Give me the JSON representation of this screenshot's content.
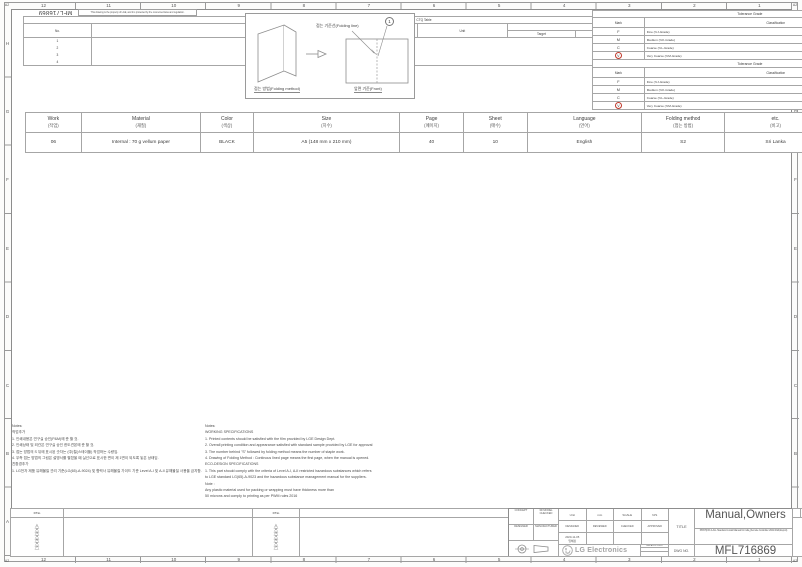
{
  "sheet": {
    "corner": "A2",
    "cols": [
      "12",
      "11",
      "10",
      "9",
      "8",
      "7",
      "6",
      "5",
      "4",
      "3",
      "2",
      "1"
    ],
    "rows": [
      "H",
      "G",
      "F",
      "E",
      "D",
      "C",
      "B",
      "A"
    ]
  },
  "header": {
    "doc_number_rotated": "MFL716869",
    "property_note": "This drawing is the property of LGE, and it is protected by the concerned laws and regulation."
  },
  "ctq": {
    "title": "CTQ Table",
    "no": "No.",
    "item": "CTQ Item",
    "unit": "Unit",
    "value_tolerance": "Value & Tolerance",
    "target": "Target",
    "lsl": "LSL",
    "usl": "USL",
    "z_value": "Z-Value",
    "zst": "Zst",
    "zlt": "Zlt",
    "row_numbers": [
      "1",
      "2",
      "3",
      "4"
    ]
  },
  "folding": {
    "line_label": "접는 기준선(Folding line)",
    "method_label": "접는 방법(Folding method)",
    "front_label": "앞면 기준(Front)",
    "callout": "1"
  },
  "tol_len": {
    "grade": "Tolerance Grade",
    "mark": "Mark",
    "classification": "Classification",
    "group": "Length(L:mm)",
    "cols": [
      "0.5~3",
      "3~6",
      "6~30",
      "30~ 120",
      "120~ 400",
      "400~ 1000",
      "1000~ 2000",
      "2000~ 4000"
    ],
    "rows": [
      {
        "mark": "F",
        "cls": "Fine (≒J-Grade)",
        "circled": false,
        "v": [
          "0.05",
          "0.05",
          "0.1",
          "0.15",
          "0.2",
          "0.3",
          "0.5",
          "-"
        ]
      },
      {
        "mark": "M",
        "cls": "Medium (≒K-Grade)",
        "circled": false,
        "v": [
          "0.1",
          "0.1",
          "0.2",
          "0.3",
          "0.5",
          "0.8",
          "1.2",
          "2.0"
        ]
      },
      {
        "mark": "C",
        "cls": "Coarse (≒L-Grade)",
        "circled": false,
        "v": [
          "0.2",
          "0.3",
          "0.5",
          "0.8",
          "1.2",
          "2.0",
          "3.0",
          "4.0"
        ]
      },
      {
        "mark": "V",
        "cls": "Very Coarse (≒M-Grade)",
        "circled": true,
        "v": [
          "-",
          "0.5",
          "1.0",
          "1.5",
          "2.5",
          "4.0",
          "6.0",
          "8.0"
        ]
      }
    ]
  },
  "tol_ra": {
    "grade": "Tolerance Grade",
    "mark": "Mark",
    "classification": "Classification",
    "round_group": "Round/Chamfer(±mm)",
    "angle_group": "Angle (±Degree° Minute' Second\")",
    "round_cols": [
      "0.5~3",
      "3~6",
      "6~"
    ],
    "angle_cols": [
      "~10",
      "10~50",
      "50~120",
      "120~ 400",
      "400~"
    ],
    "rows": [
      {
        "mark": "F",
        "cls": "Fine (≒J-Grade)",
        "circled": false,
        "r": [
          "0.2",
          "0.5",
          "1.0"
        ],
        "a": [
          "1°",
          "30'",
          "20'",
          "10'",
          "5'"
        ]
      },
      {
        "mark": "M",
        "cls": "Medium (≒K-Grade)",
        "circled": false,
        "r": [
          "0.2",
          "0.5",
          "1.0"
        ],
        "a": [
          "1°",
          "30'",
          "20'",
          "10'",
          "5'"
        ]
      },
      {
        "mark": "C",
        "cls": "Coarse (≒L-Grade)",
        "circled": false,
        "r": [
          "0.4",
          "1.0",
          "2.0"
        ],
        "a": [
          "1°30'",
          "1°",
          "30'",
          "15'",
          "10'"
        ]
      },
      {
        "mark": "V",
        "cls": "Very Coarse (≒M-Grade)",
        "circled": true,
        "r": [
          "0.4",
          "1.0",
          "2.0"
        ],
        "a": [
          "3°",
          "2°",
          "1°",
          "30'",
          "20'"
        ]
      }
    ]
  },
  "spec": {
    "cols": [
      {
        "label": "Work",
        "sub": "(작업)",
        "value": "06"
      },
      {
        "label": "Material",
        "sub": "(재질)",
        "value": "Internal : 70 g vellum paper"
      },
      {
        "label": "Color",
        "sub": "(색상)",
        "value": "BLACK"
      },
      {
        "label": "Size",
        "sub": "(치수)",
        "value": "A5 (148 mm x 210 mm)"
      },
      {
        "label": "Page",
        "sub": "(페이지)",
        "value": "40"
      },
      {
        "label": "Sheet",
        "sub": "(매수)",
        "value": "10"
      },
      {
        "label": "Language",
        "sub": "(언어)",
        "value": "English"
      },
      {
        "label": "Folding method",
        "sub": "(접는 방법)",
        "value": "S2"
      },
      {
        "label": "etc.",
        "sub": "(비고)",
        "value": "Sri Lanka"
      }
    ]
  },
  "notes_kr": {
    "lines": [
      "Notes:",
      "작업추가",
      " 1. 인쇄내용은 연구실 승인(P&M)에 준 할 것.",
      " 2. 인쇄상태 및 외관은 연구실 승인 한도견본에 준 할 것.",
      " 3. 접는 방법의 S 뒤에 표시된 숫자는 (中)철(스테이플) 작업하는 수량임.",
      " 4. 우측 접는 방법의 그림은 설명서를 펼쳤을 때 실선으로 표시한 면이 제 1면이 되도록  놓은 상태임.",
      "친환경추가",
      " 1. LG전자 제품 유해물질 관리 기준(LG(65)-A-9024) 및 협력사 유해물질 가이드 기준 Level A-I 및 A-II 유해물질 사용을 금지함."
    ]
  },
  "notes_en": {
    "lines": [
      "Notes:",
      "WORKING SPECIFICATIONS",
      " 1. Printed contents should be satisfied with the film  provided by LGE Design Dept.",
      " 2. Overall printing condition and appearance satisfied with standard sample provided by LGE for approval",
      " 3. The number behind \"S\" followed by folding method means the number of  staple work.",
      " 4. Drawing of Folding Method : Continous lined page means the first page, when   the manual is opened.",
      "ECO-DESIGN SPECIFICATIONS",
      " 1. This part should comply with the criteria of Level A-I, A-II restricted hazardous substances which refers",
      "     to LGE standard LG(65)-A-9023 and the hazardous substance management manual for the suppliers.",
      "Note :",
      " Any plastic material used for packing or wrapping must have thickness more than",
      " 50 microns and comply to printing as per PWM rules 2016"
    ]
  },
  "revision": {
    "p_no": "P/No",
    "revision": "REVISION",
    "eco_no": "ECO NO",
    "date": "DATE",
    "signed": "SIGNED",
    "marks": [
      "1",
      "2",
      "3",
      "4",
      "5",
      "6",
      "7"
    ]
  },
  "title_block": {
    "concept": "CONCEPT",
    "model_checked": "3D MODEL CHECKED",
    "designer": "DESIGNER",
    "manufacturer": "MANUFACTURER",
    "unit_label": "Unit",
    "unit_value": "mm",
    "scale_label": "SCALE",
    "scale_value": "N/S",
    "designed": "DESIGNED",
    "reviewed": "REVIEWED",
    "checked": "CHECKED",
    "approved": "APPROVED",
    "designed_date": "2020-11-05",
    "designed_name": "임혜정",
    "related_dwg": "RELATED DWG",
    "title_label": "TITLE",
    "title_value": "Manual,Owners",
    "subtitle": "PRNT(NO.4-ALL Standard model Manual for india_Remote Controller 2021 R&D,Export)",
    "dwg_no_label": "DWG NO.",
    "dwg_no_value": "MFL716869",
    "logo_text": "LG Electronics"
  },
  "colors": {
    "line": "#9a9a9a",
    "text": "#3c3c3c",
    "circle_red": "#c0392b"
  }
}
